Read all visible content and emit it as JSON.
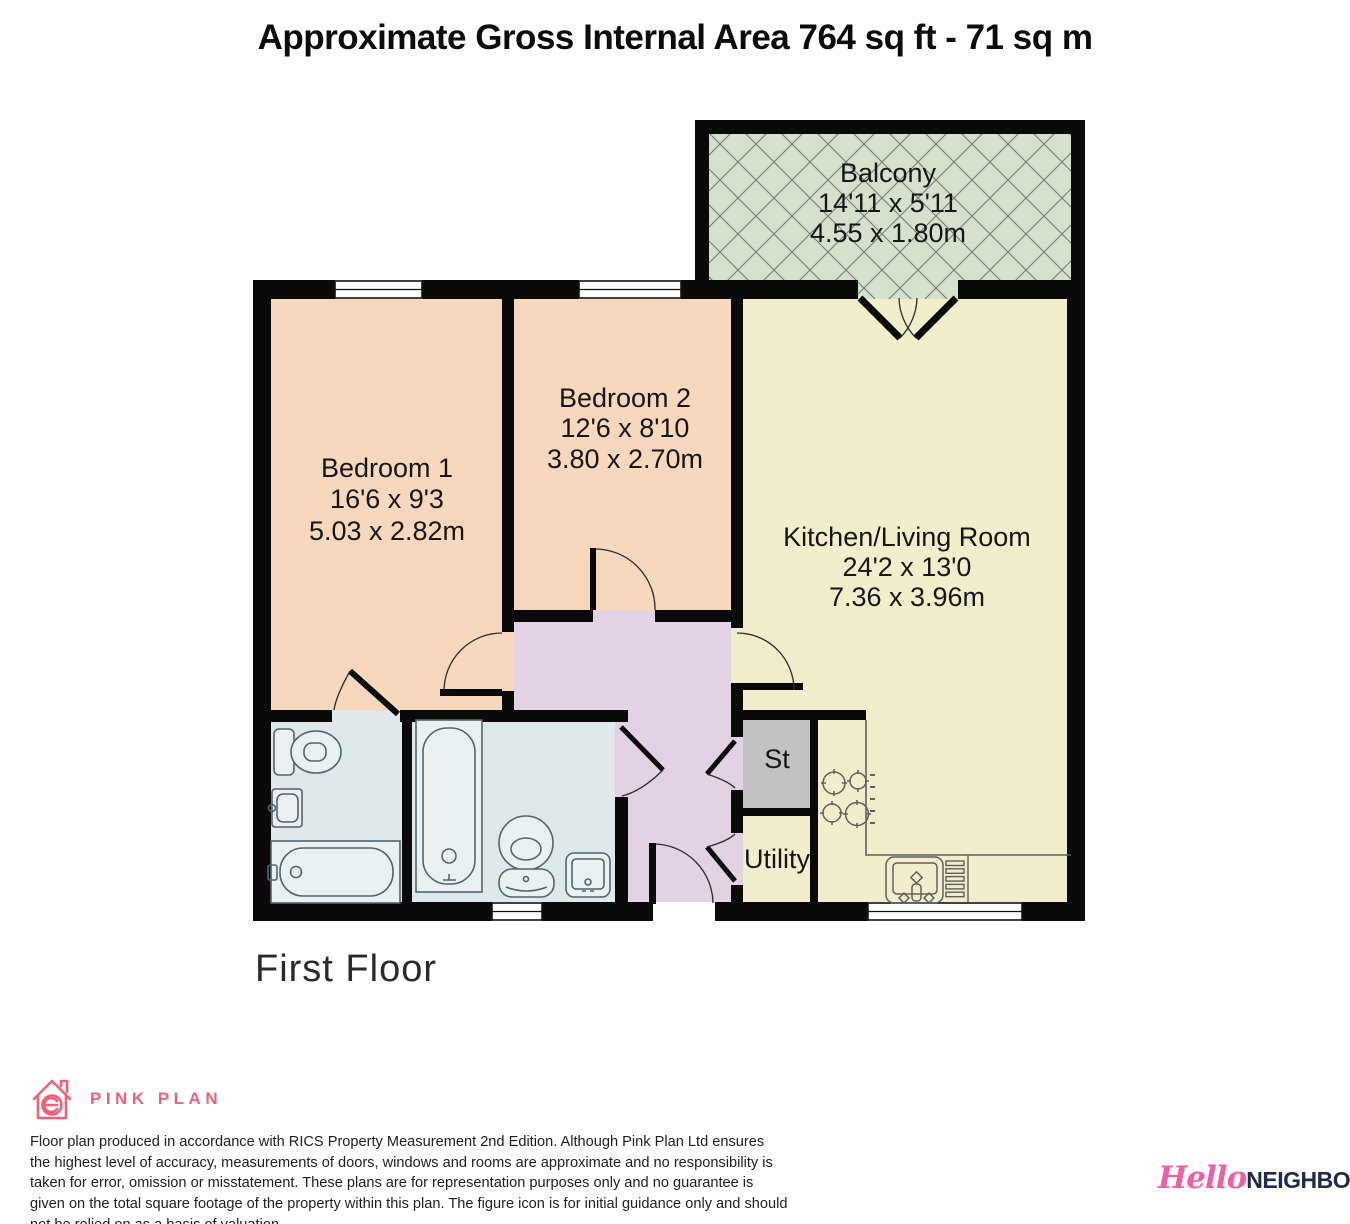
{
  "title": "Approximate Gross Internal Area 764 sq ft - 71 sq m",
  "floor_label": "First Floor",
  "rooms": [
    {
      "name": "Balcony",
      "imperial": "14'11 x 5'11",
      "metric": "4.55 x 1.80m"
    },
    {
      "name": "Bedroom 1",
      "imperial": "16'6 x 9'3",
      "metric": "5.03 x 2.82m"
    },
    {
      "name": "Bedroom 2",
      "imperial": "12'6 x 8'10",
      "metric": "3.80 x 2.70m"
    },
    {
      "name": "Kitchen/Living Room",
      "imperial": "24'2 x 13'0",
      "metric": "7.36 x 3.96m"
    },
    {
      "name": "St"
    },
    {
      "name": "Utility"
    }
  ],
  "colors": {
    "bedroom": "#f8d8bd",
    "kitchen": "#f2edca",
    "balcony": "#d5e1cd",
    "hallway": "#e3d1e4",
    "bathroom": "#dfe9ec",
    "storage": "#c2c1c4",
    "wall": "#0a0a0a",
    "producer_pink": "#f0607c",
    "agent_pink": "#ee5fa8",
    "agent_navy": "#1e2b4e"
  },
  "branding": {
    "producer_label": "PINK PLAN",
    "agent_script": "Hello",
    "agent_bold": "NEIGHBOUR"
  },
  "disclaimer": "Floor plan produced in accordance with RICS Property Measurement 2nd Edition. Although Pink Plan Ltd ensures the highest level of accuracy, measurements of doors, windows and rooms are approximate and no responsibility is taken for error, omission or misstatement. These plans are for representation purposes only and no guarantee is given on the total square footage of the property within this plan. The figure icon is for initial guidance only and should not be relied on as a basis of valuation."
}
